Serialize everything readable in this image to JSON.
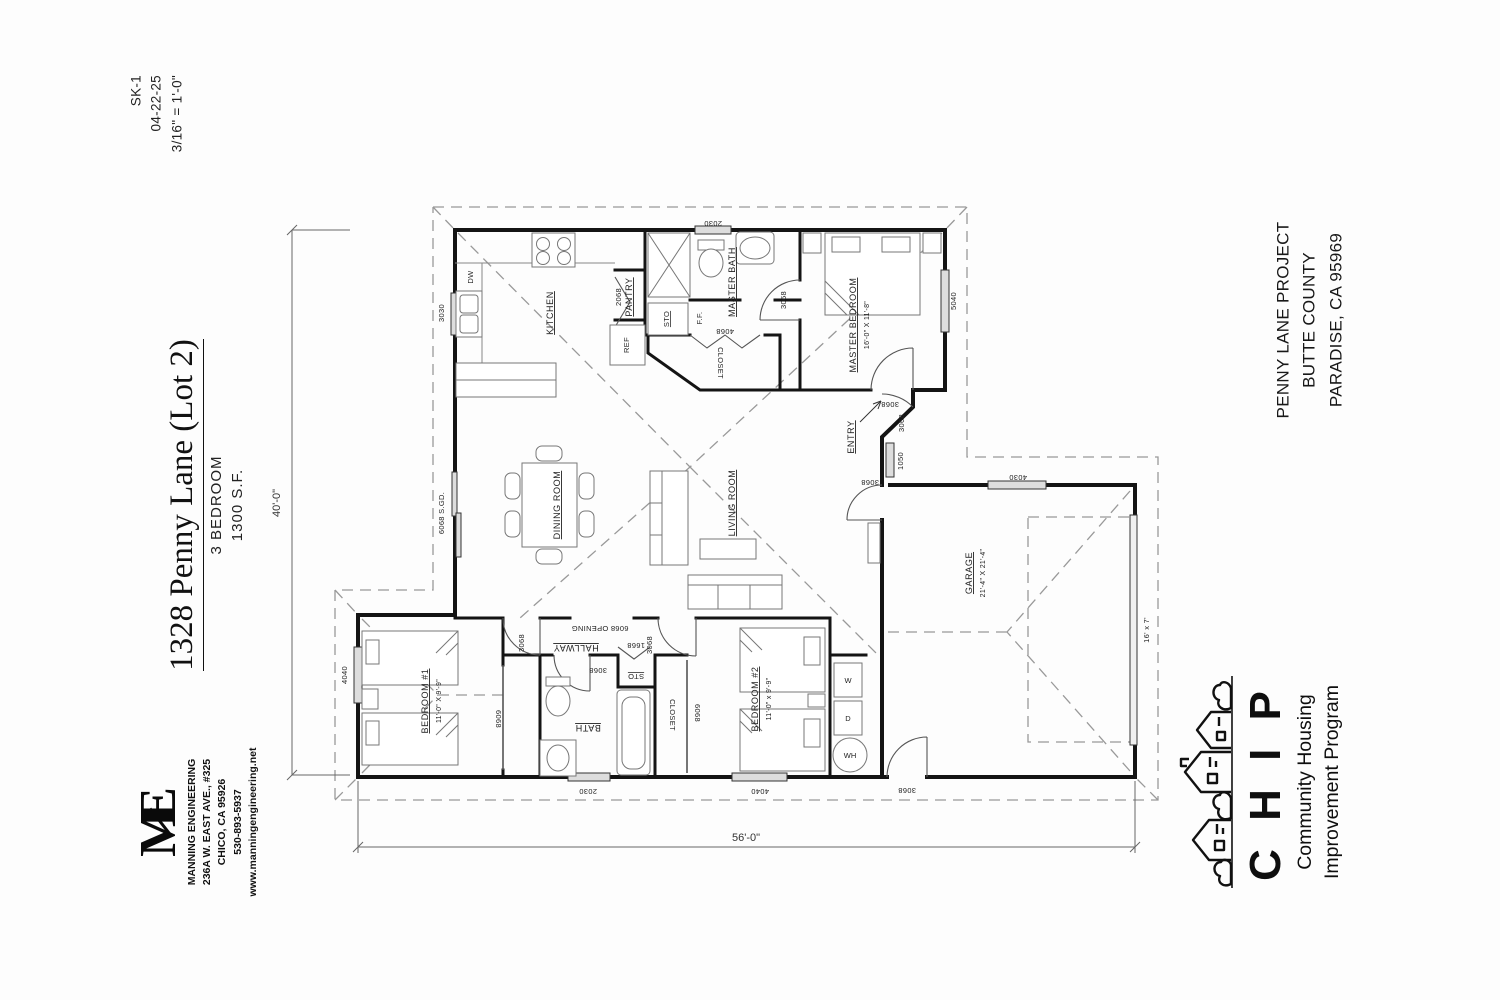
{
  "sheet_info": {
    "number": "SK-1",
    "date": "04-22-25",
    "scale": "3/16\" = 1'-0\""
  },
  "title_block": {
    "address": "1328 Penny Lane (Lot 2)",
    "bedrooms": "3 BEDROOM",
    "area": "1300 S.F."
  },
  "engineer_block": {
    "logo_text": "ME",
    "name": "MANNING ENGINEERING",
    "street": "236A W. EAST AVE., #325",
    "city": "CHICO, CA   95926",
    "phone": "530-893-5937",
    "website": "www.manningengineering.net"
  },
  "project_block": {
    "line1": "PENNY LANE PROJECT",
    "line2": "BUTTE COUNTY",
    "line3": "PARADISE, CA   95969"
  },
  "chip_block": {
    "acronym": "C H I P",
    "line1": "Community Housing",
    "line2": "Improvement Program"
  },
  "dimensions": {
    "overall_width": "56'-0\"",
    "overall_depth": "40'-0\""
  },
  "rooms": {
    "kitchen": "KITCHEN",
    "pantry": "PANTRY",
    "dining": "DINING ROOM",
    "living": "LIVING ROOM",
    "hallway": "HALLWAY",
    "entry": "ENTRY",
    "master_bath": "MASTER BATH",
    "master_closet": "CLOSET",
    "master_bedroom": "MASTER BEDROOM",
    "master_bedroom_size": "16'-0\" X 11'-8\"",
    "bedroom1": "BEDROOM #1",
    "bedroom1_size": "11'-0\" X 9'-9\"",
    "bedroom2": "BEDROOM #2",
    "bedroom2_size": "11'-0\" x 9'-9\"",
    "bath": "BATH",
    "closet2": "CLOSET",
    "garage": "GARAGE",
    "garage_size": "21'-4\" X 21'-4\"",
    "garage_door_size": "16' x 7'"
  },
  "fixtures": {
    "dishwasher": "DW",
    "refrigerator": "REF",
    "storage_kitchen": "STO",
    "finished_floor": "F.F.",
    "storage_hall": "STO",
    "washer": "W",
    "dryer": "D",
    "water_heater": "WH"
  },
  "openings": {
    "kitchen_window": "3030",
    "master_bath_window": "2030",
    "master_bedroom_window": "5040",
    "master_bedroom_door": "3068",
    "master_closet_door": "4068",
    "master_bath_door": "3068",
    "pantry_door": "2068",
    "entry_door": "3068",
    "entry_sidelight": "1050",
    "entry_living_door": "3068",
    "patio_slider": "6068 S.GD.",
    "hall_opening": "6068 OPENING",
    "bedroom1_door": "3068",
    "bedroom1_window": "4040",
    "bedroom1_closet_door": "6068",
    "bath_door": "3068",
    "bath_window": "2030",
    "hall_storage_door": "1668",
    "closet2_door": "6068",
    "bedroom2_door": "3068",
    "bedroom2_window": "4040",
    "garage_entry_door": "3068",
    "garage_window": "4030"
  }
}
